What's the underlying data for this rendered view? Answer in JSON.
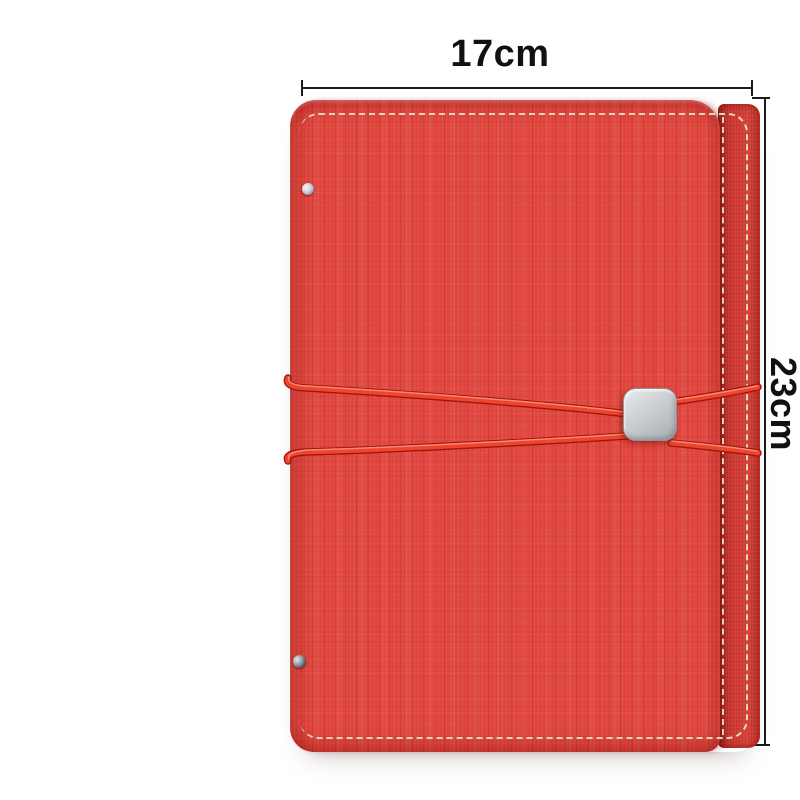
{
  "image": {
    "type": "product-photo",
    "subject": "red-faux-leather-notebook-with-elastic-cord-closure"
  },
  "annotations": {
    "width_label": "17cm",
    "height_label": "23cm"
  },
  "product_features": [
    "textured-red-cover",
    "contrast-cream-stitching",
    "double-elastic-cord-closure",
    "square-metal-buckle",
    "metal-rivets-on-left-edge",
    "spine-strip-right"
  ],
  "colors": {
    "background": "#ffffff",
    "dim_line": "#1a1a1a",
    "label_text": "#111111",
    "cover_red": "#e0463e",
    "cover_shadow_red": "#b5261f",
    "spine_red": "#d23d36",
    "cord_red": "#ee4530",
    "cord_dark_red": "#9e170b",
    "cord_highlight": "#ff9582",
    "stitch_cream": "#eadfc2",
    "buckle_silver_light": "#e9ebed",
    "buckle_silver_mid": "#cdd0d4",
    "buckle_silver_dark": "#a9adb3",
    "rivet_silver": "#ced2d6"
  }
}
